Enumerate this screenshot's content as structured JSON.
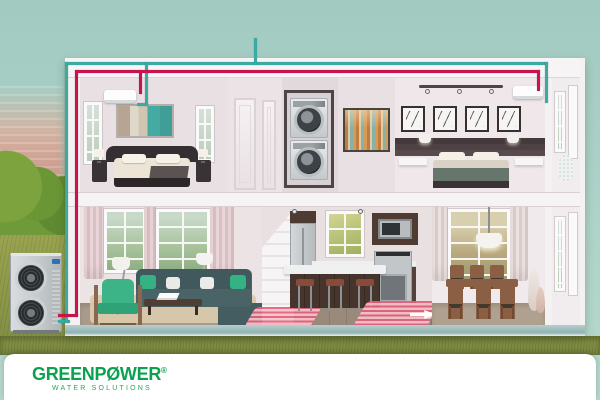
{
  "branding": {
    "brand": "GREENPØWER",
    "registered_mark": "®",
    "tagline": "WATER SOLUTIONS",
    "brand_color": "#0ba150"
  },
  "system": {
    "hot_water_pipe_color": "#c9134f",
    "cold_return_pipe_color": "#3aaaa2",
    "underfloor_heating_color": "#e2607c"
  },
  "scene": {
    "sky_color": "#a9cfc6",
    "grass_color": "#8e9a4a",
    "upper_rooms": [
      "bedroom-left",
      "hallway",
      "laundry-closet",
      "art-wall",
      "bedroom-right"
    ],
    "lower_rooms": [
      "living-room",
      "kitchen",
      "dining-room"
    ],
    "outdoor_unit": "air-source-heat-pump",
    "indoor_units": [
      "wall-ac-bedroom-left",
      "wall-ac-bedroom-right"
    ],
    "features": [
      "stacked-washer-dryer",
      "underfloor-heating-coil",
      "flow-arrow"
    ]
  }
}
